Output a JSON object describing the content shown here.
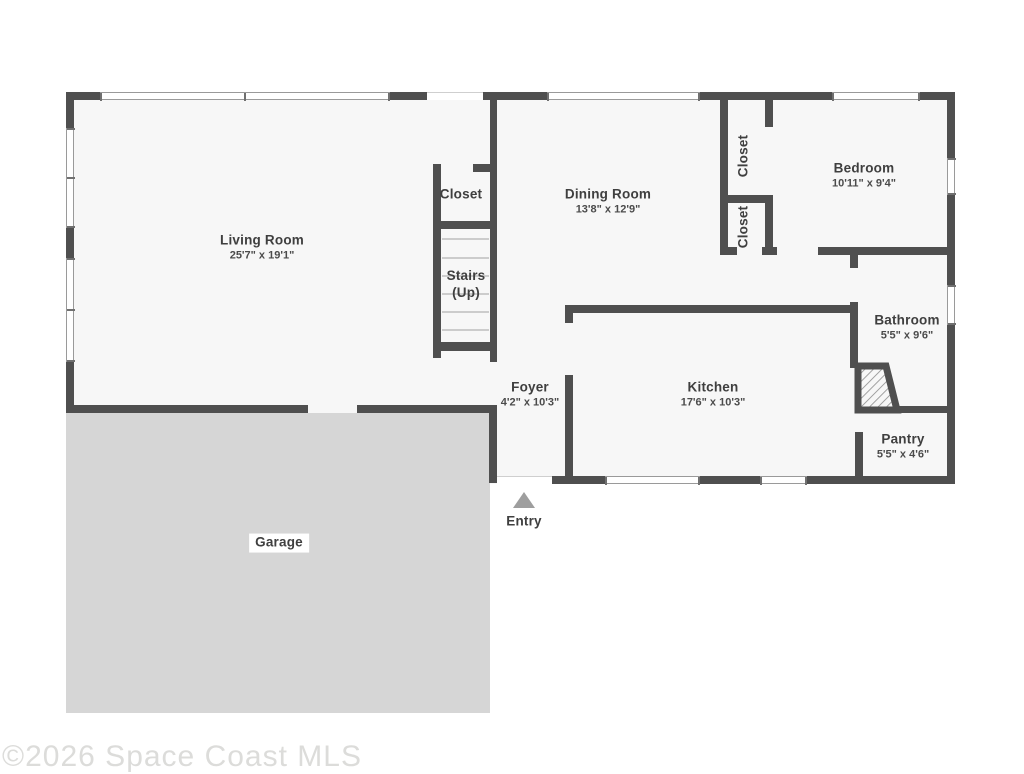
{
  "floorplan": {
    "watermark": "©2026 Space Coast MLS",
    "colors": {
      "wall": "#4f4f4f",
      "floor": "#f7f7f7",
      "garage_fill": "#d6d6d6",
      "window_line": "#9a9a9a",
      "window_cap": "#707070",
      "stair_tread": "#cccccc",
      "entry_arrow": "#9e9e9e",
      "label_text": "#3f3f3f",
      "dim_text": "#4b4b4b",
      "watermark_text": "#dcdcda"
    },
    "rooms": [
      {
        "id": "living-room",
        "label": "Living Room",
        "dim": "25'7\" x 19'1\"",
        "cx": 262,
        "cy": 248
      },
      {
        "id": "stairs-closet",
        "label": "Closet",
        "dim": "",
        "cx": 461,
        "cy": 195
      },
      {
        "id": "stairs",
        "label": "Stairs",
        "dim": "(Up)",
        "cx": 466,
        "cy": 285,
        "stairs": true
      },
      {
        "id": "dining-room",
        "label": "Dining Room",
        "dim": "13'8\" x 12'9\"",
        "cx": 608,
        "cy": 202
      },
      {
        "id": "hall-closet-upper",
        "label": "Closet",
        "dim": "",
        "cx": 744,
        "cy": 156,
        "vertical": true
      },
      {
        "id": "hall-closet-lower",
        "label": "Closet",
        "dim": "",
        "cx": 744,
        "cy": 227,
        "vertical": true
      },
      {
        "id": "bedroom",
        "label": "Bedroom",
        "dim": "10'11\" x 9'4\"",
        "cx": 864,
        "cy": 176
      },
      {
        "id": "bathroom",
        "label": "Bathroom",
        "dim": "5'5\" x 9'6\"",
        "cx": 907,
        "cy": 328
      },
      {
        "id": "foyer",
        "label": "Foyer",
        "dim": "4'2\" x 10'3\"",
        "cx": 530,
        "cy": 395
      },
      {
        "id": "kitchen",
        "label": "Kitchen",
        "dim": "17'6\" x 10'3\"",
        "cx": 713,
        "cy": 395
      },
      {
        "id": "pantry",
        "label": "Pantry",
        "dim": "5'5\" x 4'6\"",
        "cx": 903,
        "cy": 447
      }
    ],
    "garage": {
      "label": "Garage",
      "rect": [
        66,
        413,
        424,
        300
      ],
      "label_cx": 279,
      "label_cy": 543
    },
    "entry": {
      "label": "Entry",
      "arrow_x": 513,
      "arrow_y": 492,
      "label_cx": 524,
      "label_cy": 522
    },
    "floor_areas": [
      [
        66,
        92,
        889,
        321
      ],
      [
        489,
        413,
        466,
        71
      ]
    ],
    "walls": [
      [
        66,
        92,
        34,
        8
      ],
      [
        390,
        92,
        37,
        8
      ],
      [
        483,
        92,
        64,
        8
      ],
      [
        700,
        92,
        132,
        8
      ],
      [
        920,
        92,
        35,
        8
      ],
      [
        66,
        100,
        8,
        28
      ],
      [
        66,
        228,
        8,
        30
      ],
      [
        66,
        362,
        8,
        51
      ],
      [
        947,
        100,
        8,
        58
      ],
      [
        947,
        195,
        8,
        90
      ],
      [
        947,
        325,
        8,
        158
      ],
      [
        66,
        405,
        242,
        8
      ],
      [
        357,
        405,
        140,
        8
      ],
      [
        489,
        405,
        8,
        78
      ],
      [
        552,
        476,
        53,
        8
      ],
      [
        700,
        476,
        60,
        8
      ],
      [
        807,
        476,
        148,
        8
      ],
      [
        490,
        92,
        7,
        270
      ],
      [
        433,
        164,
        8,
        194
      ],
      [
        433,
        164,
        7,
        8
      ],
      [
        473,
        164,
        17,
        8
      ],
      [
        441,
        221,
        49,
        8
      ],
      [
        433,
        342,
        64,
        9
      ],
      [
        720,
        100,
        8,
        155
      ],
      [
        720,
        195,
        53,
        8
      ],
      [
        765,
        100,
        8,
        27
      ],
      [
        765,
        203,
        8,
        45
      ],
      [
        720,
        247,
        17,
        8
      ],
      [
        762,
        247,
        15,
        8
      ],
      [
        818,
        247,
        137,
        8
      ],
      [
        850,
        255,
        8,
        13
      ],
      [
        850,
        302,
        8,
        66
      ],
      [
        567,
        305,
        283,
        8
      ],
      [
        565,
        305,
        8,
        18
      ],
      [
        565,
        375,
        8,
        101
      ],
      [
        858,
        406,
        92,
        7
      ],
      [
        855,
        432,
        8,
        44
      ]
    ],
    "windows": [
      {
        "rect": [
          100,
          92,
          290,
          8
        ],
        "orient": "h",
        "mid": true
      },
      {
        "rect": [
          547,
          92,
          153,
          8
        ],
        "orient": "h",
        "mid": false
      },
      {
        "rect": [
          832,
          92,
          88,
          8
        ],
        "orient": "h",
        "mid": false
      },
      {
        "rect": [
          66,
          128,
          8,
          100
        ],
        "orient": "v",
        "mid": true
      },
      {
        "rect": [
          66,
          258,
          8,
          104
        ],
        "orient": "v",
        "mid": true
      },
      {
        "rect": [
          947,
          158,
          8,
          37
        ],
        "orient": "v",
        "mid": false
      },
      {
        "rect": [
          947,
          285,
          8,
          40
        ],
        "orient": "v",
        "mid": false
      },
      {
        "rect": [
          605,
          476,
          95,
          8
        ],
        "orient": "h",
        "mid": false
      },
      {
        "rect": [
          760,
          476,
          47,
          8
        ],
        "orient": "h",
        "mid": false
      }
    ],
    "openings": [
      {
        "rect": [
          427,
          92,
          56,
          8
        ]
      },
      {
        "rect": [
          497,
          476,
          55,
          8
        ]
      }
    ],
    "stair_treads": {
      "x": 442,
      "w": 47,
      "h": 2,
      "ys": [
        238,
        257,
        275,
        293,
        311,
        329
      ]
    },
    "corner_fixture": {
      "svg_x": 850,
      "svg_y": 358,
      "points": "8,8 36,8 47,52 8,52"
    }
  }
}
